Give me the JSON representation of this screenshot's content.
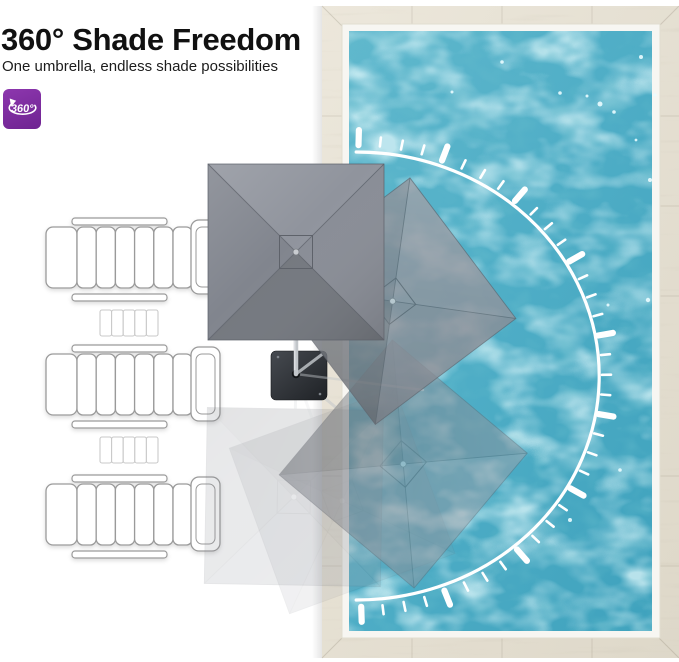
{
  "header": {
    "title": "360° Shade Freedom",
    "subtitle": "One umbrella, endless shade possibilities",
    "badge_label": "360°"
  },
  "colors": {
    "accent_purple": "#7e2d9e",
    "water_base": "#4fadc6",
    "deck_beige": "#e6e1d3",
    "coping_white": "#f7f6f2",
    "canopy_gray": "#84888f",
    "canopy_dark_panel": "#74787f",
    "arc_white": "#ffffff",
    "umbrella_base_dark": "#2e3135",
    "chair_outline": "#9a9a9a",
    "table_outline": "#c9c9c9"
  },
  "diagram": {
    "pivot": {
      "x": 296,
      "y": 374
    },
    "canopy_size": 176,
    "umbrellas": [
      {
        "name": "ghost-down",
        "angle": 181,
        "distance": 123,
        "opacity": 0.18,
        "main": false
      },
      {
        "name": "ghost-down-left",
        "angle": 160,
        "distance": 135,
        "opacity": 0.12,
        "main": false
      },
      {
        "name": "ghost-down-right",
        "angle": 130,
        "distance": 140,
        "opacity": 0.5,
        "main": false
      },
      {
        "name": "rotated-right",
        "angle": 53,
        "distance": 121,
        "opacity": 0.82,
        "main": false
      },
      {
        "name": "main",
        "angle": 0,
        "distance": 122,
        "opacity": 1.0,
        "main": true
      }
    ],
    "rotation_arc": {
      "cx": 352,
      "cy": 376,
      "rx": 243,
      "ry": 224,
      "start_deg": -89,
      "end_deg": 89,
      "tick_start_deg": -88.5,
      "tick_step_deg": 4.9,
      "tick_count": 37,
      "major_every": 4
    },
    "pool": {
      "deck": {
        "x": 322,
        "y": 6,
        "w": 357,
        "h": 652
      },
      "coping": {
        "x": 342,
        "y": 24,
        "w": 318,
        "h": 614
      },
      "water": {
        "x": 349,
        "y": 31,
        "w": 303,
        "h": 600
      }
    },
    "chairs": {
      "x": 46,
      "tops": [
        218,
        345,
        475
      ]
    },
    "side_tables": {
      "x": 100,
      "tops": [
        310,
        437
      ]
    }
  }
}
